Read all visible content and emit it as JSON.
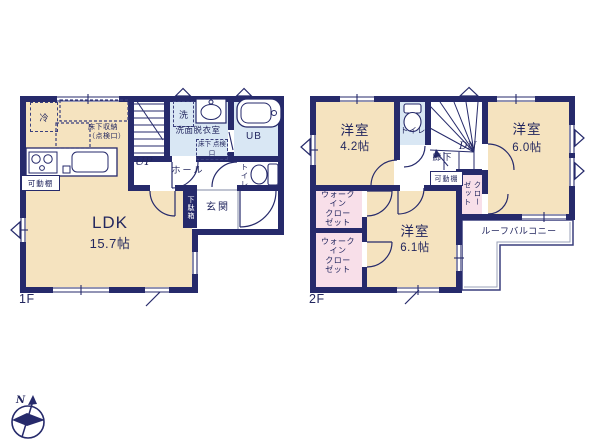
{
  "colors": {
    "wall": "#262a6b",
    "text": "#23275f",
    "tan": "#f5e3bf",
    "blue": "#d9e7f4",
    "pink": "#f8dfe9",
    "gray": "#9aa0b8"
  },
  "floor1": {
    "label": "1F",
    "ldk_name": "LDK",
    "ldk_area": "15.7帖",
    "hall": "ホール",
    "entrance": "玄関",
    "shoe_cabinet": "下駄箱",
    "washroom": "洗面脱衣室",
    "bath": "UB",
    "toilet": "トイレ",
    "stairs_up": "UP",
    "fridge": "冷",
    "washer": "洗",
    "floor_storage": "床下収納\n（点検口）",
    "floor_hatch": "床下\n点検口",
    "movable_shelf": "可動棚"
  },
  "floor2": {
    "label": "2F",
    "room_a_name": "洋室",
    "room_a_area": "4.2帖",
    "room_b_name": "洋室",
    "room_b_area": "6.0帖",
    "room_c_name": "洋室",
    "room_c_area": "6.1帖",
    "toilet": "トイレ",
    "corridor": "廊下",
    "stairs_down": "DN",
    "wic_a": "ウォーク\nイン\nクロー\nゼット",
    "wic_b": "ウォーク\nイン\nクロー\nゼット",
    "closet": "クローゼット",
    "movable_shelf": "可動棚",
    "roof_balcony": "ルーフバルコニー"
  },
  "compass": {
    "north": "N"
  }
}
